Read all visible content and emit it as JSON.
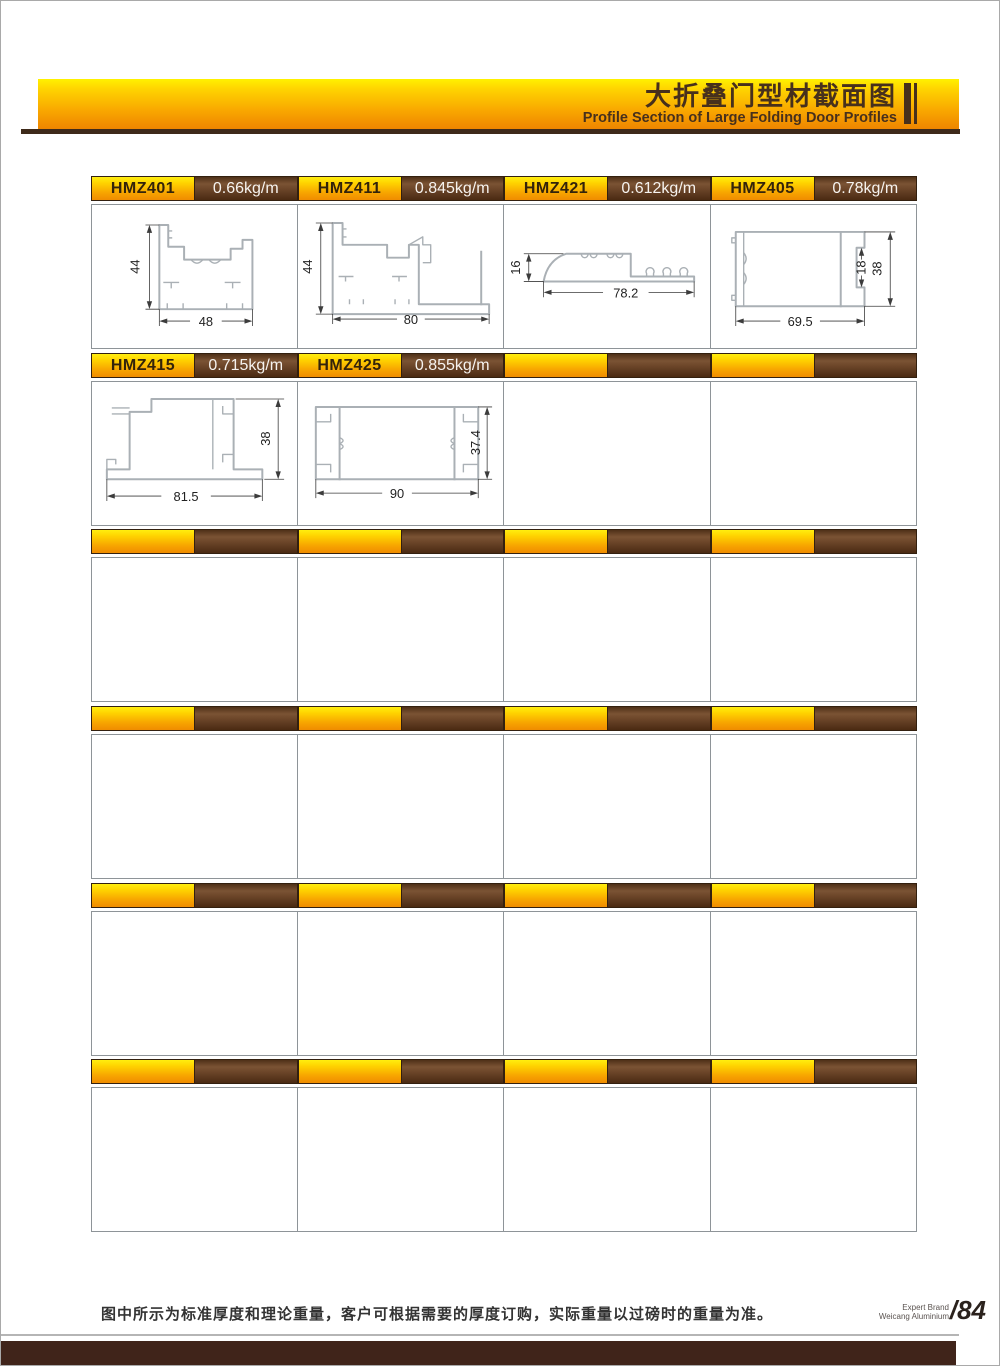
{
  "header": {
    "title_zh": "大折叠门型材截面图",
    "title_en": "Profile Section of Large Folding Door Profiles"
  },
  "profiles": [
    {
      "model": "HMZ401",
      "weight": "0.66kg/m",
      "dims": {
        "h": "44",
        "w": "48"
      }
    },
    {
      "model": "HMZ411",
      "weight": "0.845kg/m",
      "dims": {
        "h": "44",
        "w": "80"
      }
    },
    {
      "model": "HMZ421",
      "weight": "0.612kg/m",
      "dims": {
        "h": "16",
        "w": "78.2"
      }
    },
    {
      "model": "HMZ405",
      "weight": "0.78kg/m",
      "dims": {
        "slot": "18",
        "h": "38",
        "w": "69.5"
      }
    },
    {
      "model": "HMZ415",
      "weight": "0.715kg/m",
      "dims": {
        "h": "38",
        "w": "81.5"
      }
    },
    {
      "model": "HMZ425",
      "weight": "0.855kg/m",
      "dims": {
        "h": "37.4",
        "w": "90"
      }
    }
  ],
  "footer": {
    "note": "图中所示为标准厚度和理论重量，客户可根据需要的厚度订购，实际重量以过磅时的重量为准。",
    "brand1": "Expert Brand",
    "brand2": "Weicang Aluminium",
    "page_num": "/84"
  },
  "colors": {
    "gold": "#f9a800",
    "brown": "#4a2c16",
    "header_text": "#47301c"
  }
}
